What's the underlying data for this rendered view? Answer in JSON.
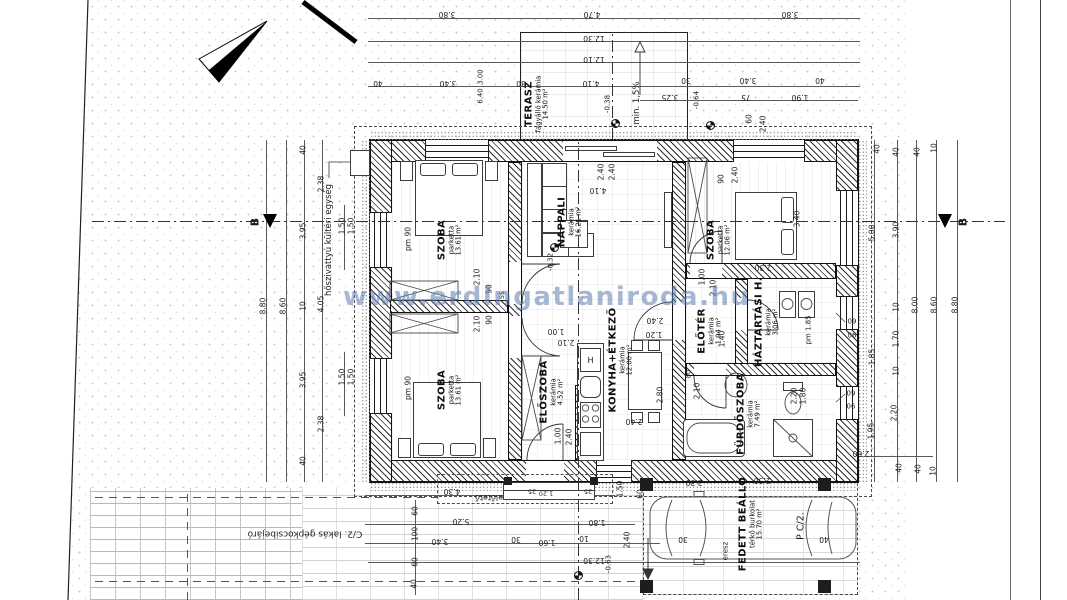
{
  "watermark": {
    "text": "www.erdingatlaniroda.hu",
    "color": "#5c7cb0"
  },
  "rooms": [
    {
      "name": "TERASZ",
      "material": "fagyálló kerámia",
      "area": "14.50 m²",
      "x": 537,
      "y": 104
    },
    {
      "name": "NAPPALI",
      "material": "kerámia",
      "area": "16.21 m²",
      "x": 570,
      "y": 222
    },
    {
      "name": "SZOBA",
      "material": "parketta",
      "area": "13.61 m²",
      "x": 450,
      "y": 240
    },
    {
      "name": "SZOBA",
      "material": "parketta",
      "area": "13.61 m²",
      "x": 450,
      "y": 390
    },
    {
      "name": "SZOBA",
      "material": "parketta",
      "area": "12.06 m²",
      "x": 719,
      "y": 240
    },
    {
      "name": "ELŐSZOBA",
      "material": "kerámia",
      "area": "4.52 m²",
      "x": 552,
      "y": 392
    },
    {
      "name": "KONYHA+ÉTKEZŐ",
      "material": "kerámia",
      "area": "12.00 m²",
      "x": 621,
      "y": 360
    },
    {
      "name": "ELŐTÉR",
      "material": "kerámia",
      "area": "1.94 m²",
      "x": 710,
      "y": 331
    },
    {
      "name": "HÁZTARTÁSI H.",
      "material": "kerámia",
      "area": "3.06 m²",
      "x": 767,
      "y": 322
    },
    {
      "name": "FÜRDŐSZOBA",
      "material": "kerámia",
      "area": "7.49 m²",
      "x": 749,
      "y": 414
    },
    {
      "name": "FEDETT BEÁLLÓ",
      "material": "térkő burkolat",
      "area": "15.70 m²",
      "x": 751,
      "y": 524
    }
  ],
  "notes": [
    {
      "t": "hőszivattyú kültéri egység",
      "x": 329,
      "y": 240,
      "r": -90,
      "s": 8.5
    },
    {
      "t": "C/2. lakás gépkocsibejáró",
      "x": 305,
      "y": 533,
      "r": 180,
      "s": 9
    },
    {
      "t": "P C/2.",
      "x": 801,
      "y": 526,
      "r": -90,
      "s": 9.5
    },
    {
      "t": "előtető",
      "x": 489,
      "y": 497,
      "r": 180,
      "s": 8
    },
    {
      "t": "eresz",
      "x": 726,
      "y": 551,
      "r": -90,
      "s": 7
    },
    {
      "t": "min. 1,5%",
      "x": 637,
      "y": 103,
      "r": -90,
      "s": 8.5
    },
    {
      "t": "pm 90",
      "x": 408,
      "y": 239,
      "r": -90,
      "s": 7.5
    },
    {
      "t": "pm 90",
      "x": 408,
      "y": 388,
      "r": -90,
      "s": 7.5
    },
    {
      "t": "pm 1.85",
      "x": 809,
      "y": 330,
      "r": -90,
      "s": 7
    },
    {
      "t": "B",
      "x": 255,
      "y": 222,
      "r": -90,
      "s": 11,
      "b": 1
    },
    {
      "t": "B",
      "x": 963,
      "y": 222,
      "r": -90,
      "s": 11,
      "b": 1
    }
  ],
  "levels": [
    {
      "t": "-0.32",
      "x": 551,
      "y": 262,
      "r": -90,
      "s": 7
    },
    {
      "t": "-0.38",
      "x": 608,
      "y": 104,
      "r": -90,
      "s": 7
    },
    {
      "t": "-0.64",
      "x": 697,
      "y": 100,
      "r": -90,
      "s": 7
    },
    {
      "t": "-0.63",
      "x": 609,
      "y": 564,
      "r": -90,
      "s": 7
    }
  ],
  "dims": [
    {
      "t": "3.80",
      "x": 447,
      "y": 14,
      "r": 180
    },
    {
      "t": "4.70",
      "x": 592,
      "y": 14,
      "r": 180
    },
    {
      "t": "3.80",
      "x": 790,
      "y": 14,
      "r": 180
    },
    {
      "t": "12.30",
      "x": 594,
      "y": 38,
      "r": 180
    },
    {
      "t": "12.10",
      "x": 594,
      "y": 59,
      "r": 180
    },
    {
      "t": "40",
      "x": 378,
      "y": 83,
      "r": 180
    },
    {
      "t": "3.40",
      "x": 448,
      "y": 83,
      "r": 180
    },
    {
      "t": "30",
      "x": 521,
      "y": 83,
      "r": 180
    },
    {
      "t": "4.10",
      "x": 591,
      "y": 83,
      "r": 180
    },
    {
      "t": "30",
      "x": 686,
      "y": 80,
      "r": 180
    },
    {
      "t": "3.40",
      "x": 748,
      "y": 80,
      "r": 180
    },
    {
      "t": "40",
      "x": 820,
      "y": 80,
      "r": 180
    },
    {
      "t": "3.00",
      "x": 481,
      "y": 77,
      "r": -90,
      "s": 6.8
    },
    {
      "t": "6.40",
      "x": 481,
      "y": 96,
      "r": -90,
      "s": 6.8
    },
    {
      "t": "3.25",
      "x": 670,
      "y": 97,
      "r": 180
    },
    {
      "t": "75",
      "x": 746,
      "y": 97,
      "r": 180
    },
    {
      "t": "1.90",
      "x": 800,
      "y": 97,
      "r": 180
    },
    {
      "t": "60",
      "x": 749,
      "y": 119,
      "r": -90
    },
    {
      "t": "2.40",
      "x": 763,
      "y": 124,
      "r": -90
    },
    {
      "t": "2.40",
      "x": 601,
      "y": 172,
      "r": -90
    },
    {
      "t": "2.40",
      "x": 612,
      "y": 172,
      "r": -90
    },
    {
      "t": "4.10",
      "x": 598,
      "y": 190,
      "r": 180
    },
    {
      "t": "8.80",
      "x": 263,
      "y": 306,
      "r": -90
    },
    {
      "t": "8.60",
      "x": 283,
      "y": 306,
      "r": -90
    },
    {
      "t": "40",
      "x": 303,
      "y": 150,
      "r": -90
    },
    {
      "t": "3.95",
      "x": 303,
      "y": 231,
      "r": -90
    },
    {
      "t": "10",
      "x": 303,
      "y": 306,
      "r": -90
    },
    {
      "t": "3.95",
      "x": 303,
      "y": 380,
      "r": -90
    },
    {
      "t": "40",
      "x": 303,
      "y": 461,
      "r": -90
    },
    {
      "t": "2.38",
      "x": 321,
      "y": 184,
      "r": -90
    },
    {
      "t": "4.05",
      "x": 321,
      "y": 304,
      "r": -90
    },
    {
      "t": "2.38",
      "x": 321,
      "y": 424,
      "r": -90
    },
    {
      "t": "1.50",
      "x": 342,
      "y": 226,
      "r": -90
    },
    {
      "t": "1.50",
      "x": 351,
      "y": 226,
      "r": -90
    },
    {
      "t": "1.50",
      "x": 342,
      "y": 377,
      "r": -90
    },
    {
      "t": "1.50",
      "x": 351,
      "y": 377,
      "r": -90
    },
    {
      "t": "2.10",
      "x": 477,
      "y": 277,
      "r": -90
    },
    {
      "t": "90",
      "x": 489,
      "y": 289,
      "r": -90
    },
    {
      "t": "55",
      "x": 502,
      "y": 295,
      "r": -90,
      "s": 6.5
    },
    {
      "t": "2.10",
      "x": 477,
      "y": 324,
      "r": -90
    },
    {
      "t": "90",
      "x": 489,
      "y": 320,
      "r": -90
    },
    {
      "t": "1.00",
      "x": 556,
      "y": 331,
      "r": 180
    },
    {
      "t": "2.10",
      "x": 566,
      "y": 342,
      "r": 180
    },
    {
      "t": "2.40",
      "x": 655,
      "y": 320,
      "r": 180
    },
    {
      "t": "1.20",
      "x": 654,
      "y": 334,
      "r": 180
    },
    {
      "t": "2.80",
      "x": 660,
      "y": 395,
      "r": -90
    },
    {
      "t": "2.40",
      "x": 634,
      "y": 421,
      "r": 180
    },
    {
      "t": "90",
      "x": 721,
      "y": 179,
      "r": -90
    },
    {
      "t": "2.40",
      "x": 735,
      "y": 175,
      "r": -90
    },
    {
      "t": "3.40",
      "x": 797,
      "y": 219,
      "r": -90
    },
    {
      "t": "2.30",
      "x": 763,
      "y": 267,
      "r": 180
    },
    {
      "t": "1.00",
      "x": 702,
      "y": 277,
      "r": -90
    },
    {
      "t": "2.10",
      "x": 713,
      "y": 288,
      "r": -90
    },
    {
      "t": "1.40",
      "x": 722,
      "y": 339,
      "r": -90
    },
    {
      "t": "80",
      "x": 689,
      "y": 374,
      "r": -90,
      "s": 6.8
    },
    {
      "t": "2.10",
      "x": 697,
      "y": 391,
      "r": -90
    },
    {
      "t": "2.20",
      "x": 794,
      "y": 396,
      "r": -90
    },
    {
      "t": "1.80",
      "x": 803,
      "y": 396,
      "r": -90
    },
    {
      "t": "2.30",
      "x": 762,
      "y": 480,
      "r": 180
    },
    {
      "t": "40",
      "x": 877,
      "y": 149,
      "r": -90
    },
    {
      "t": "5.00",
      "x": 872,
      "y": 233,
      "r": -90
    },
    {
      "t": "1.85",
      "x": 872,
      "y": 357,
      "r": -90
    },
    {
      "t": "1.95",
      "x": 871,
      "y": 431,
      "r": -90
    },
    {
      "t": "40",
      "x": 896,
      "y": 152,
      "r": -90
    },
    {
      "t": "3.90",
      "x": 896,
      "y": 230,
      "r": -90
    },
    {
      "t": "10",
      "x": 896,
      "y": 307,
      "r": -90
    },
    {
      "t": "1.70",
      "x": 896,
      "y": 339,
      "r": -90
    },
    {
      "t": "10",
      "x": 896,
      "y": 371,
      "r": -90
    },
    {
      "t": "2.20",
      "x": 894,
      "y": 413,
      "r": -90
    },
    {
      "t": "40",
      "x": 899,
      "y": 468,
      "r": -90
    },
    {
      "t": "8.00",
      "x": 915,
      "y": 305,
      "r": -90
    },
    {
      "t": "8.60",
      "x": 934,
      "y": 305,
      "r": -90
    },
    {
      "t": "8.80",
      "x": 955,
      "y": 305,
      "r": -90
    },
    {
      "t": "40",
      "x": 917,
      "y": 152,
      "r": -90
    },
    {
      "t": "40",
      "x": 918,
      "y": 469,
      "r": -90
    },
    {
      "t": "10",
      "x": 934,
      "y": 148,
      "r": -90
    },
    {
      "t": "10",
      "x": 933,
      "y": 471,
      "r": -90
    },
    {
      "t": "09",
      "x": 852,
      "y": 322,
      "r": 0,
      "s": 7
    },
    {
      "t": "06",
      "x": 852,
      "y": 336,
      "r": 0,
      "s": 7
    },
    {
      "t": "09",
      "x": 851,
      "y": 394,
      "r": 0,
      "s": 7
    },
    {
      "t": "06",
      "x": 851,
      "y": 407,
      "r": 0,
      "s": 7
    },
    {
      "t": "4.30",
      "x": 452,
      "y": 491,
      "r": 180
    },
    {
      "t": "5.20",
      "x": 461,
      "y": 521,
      "r": 180
    },
    {
      "t": "1.80",
      "x": 597,
      "y": 522,
      "r": 180
    },
    {
      "t": "3.40",
      "x": 440,
      "y": 541,
      "r": 180
    },
    {
      "t": "30",
      "x": 516,
      "y": 539,
      "r": 180
    },
    {
      "t": "1.60",
      "x": 547,
      "y": 542,
      "r": 180
    },
    {
      "t": "10",
      "x": 584,
      "y": 538,
      "r": 180
    },
    {
      "t": "2.40",
      "x": 627,
      "y": 540,
      "r": -90
    },
    {
      "t": "12.30",
      "x": 594,
      "y": 560,
      "r": 180
    },
    {
      "t": "60",
      "x": 415,
      "y": 511,
      "r": -90
    },
    {
      "t": "100",
      "x": 415,
      "y": 534,
      "r": -90
    },
    {
      "t": "60",
      "x": 415,
      "y": 562,
      "r": -90
    },
    {
      "t": "40",
      "x": 414,
      "y": 584,
      "r": -90
    },
    {
      "t": "25",
      "x": 532,
      "y": 491,
      "r": 180,
      "s": 6.5
    },
    {
      "t": "1.20",
      "x": 546,
      "y": 493,
      "r": 180,
      "s": 6.5
    },
    {
      "t": "25",
      "x": 588,
      "y": 491,
      "r": 180,
      "s": 6.5
    },
    {
      "t": "1.50",
      "x": 620,
      "y": 489,
      "r": -90
    },
    {
      "t": "60",
      "x": 640,
      "y": 494,
      "r": -90
    },
    {
      "t": "1.00",
      "x": 558,
      "y": 436,
      "r": -90
    },
    {
      "t": "2.40",
      "x": 569,
      "y": 437,
      "r": -90
    },
    {
      "t": "2.30",
      "x": 694,
      "y": 482,
      "r": 180
    },
    {
      "t": "30",
      "x": 683,
      "y": 539,
      "r": 180
    },
    {
      "t": "40",
      "x": 824,
      "y": 539,
      "r": 180
    },
    {
      "t": "2.60",
      "x": 861,
      "y": 453,
      "r": 180
    }
  ],
  "symbols": {
    "north_arrow": "north-arrow",
    "section_label": "B",
    "kitchen_fridge": "H"
  }
}
